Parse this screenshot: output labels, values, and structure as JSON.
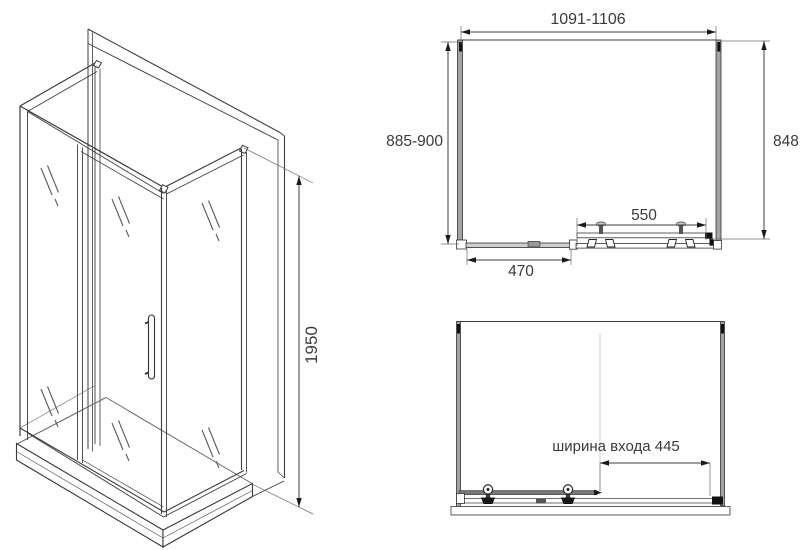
{
  "drawing_title": "shower-enclosure-technical-drawing",
  "colors": {
    "background": "#ffffff",
    "line": "#3d3d3d",
    "profile_gray": "#a3a3a3",
    "text": "#3a3a3a",
    "arrow": "#1a1a1a"
  },
  "iso_view": {
    "height_dim": "1950"
  },
  "top_view": {
    "overall_width_dim": "1091-1106",
    "depth_dim": "885-900",
    "side_height_dim": "848",
    "door_dim": "550",
    "fixed_panel_dim": "470"
  },
  "front_view": {
    "entry_width_dim": "ширина входа 445"
  }
}
